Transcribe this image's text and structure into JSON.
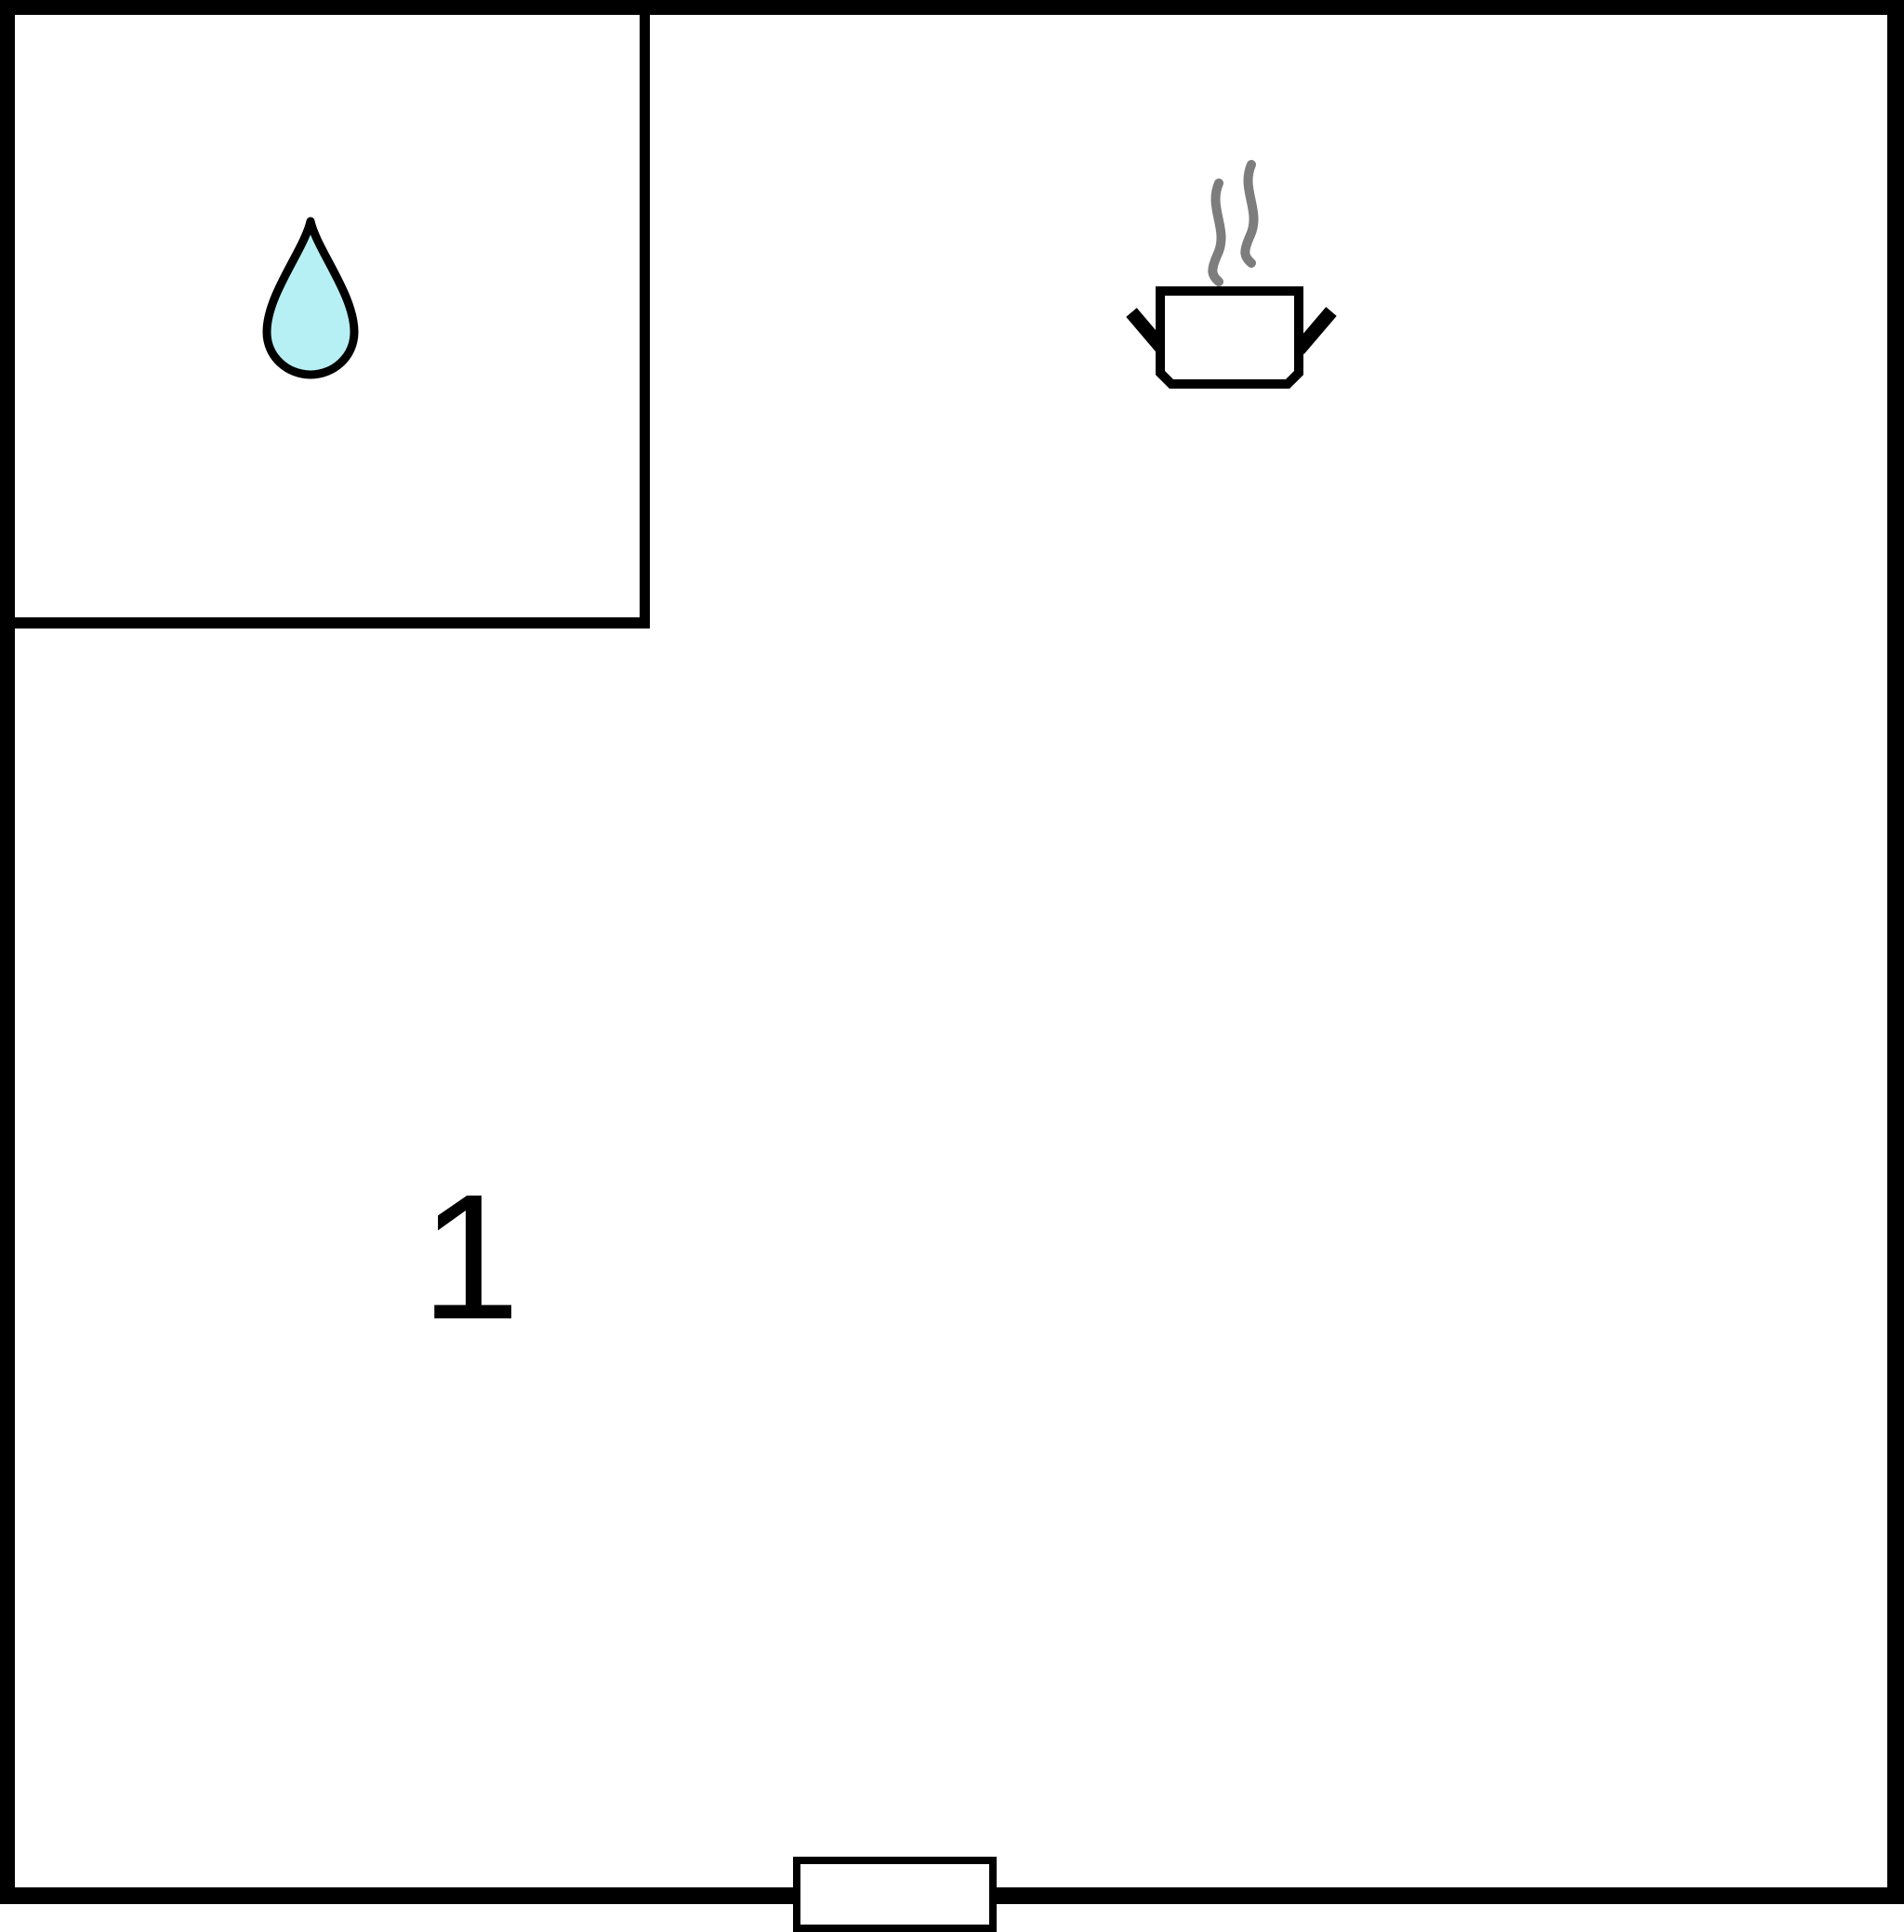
{
  "floor_plan": {
    "room_number": "1",
    "rooms": [
      {
        "id": "small-room",
        "icon": "water-drop"
      },
      {
        "id": "main-room",
        "icon": "cooking-pot-with-steam",
        "label": "1"
      }
    ],
    "icons": {
      "water_drop": "water-drop-icon",
      "cooking_pot": "cooking-pot-with-steam-icon",
      "door": "door-opening-marker"
    },
    "colors": {
      "wall": "#000000",
      "background": "#ffffff",
      "outline": "#000000",
      "water_drop_fill": "#b6f0f4",
      "steam": "#7d7d7d"
    }
  }
}
